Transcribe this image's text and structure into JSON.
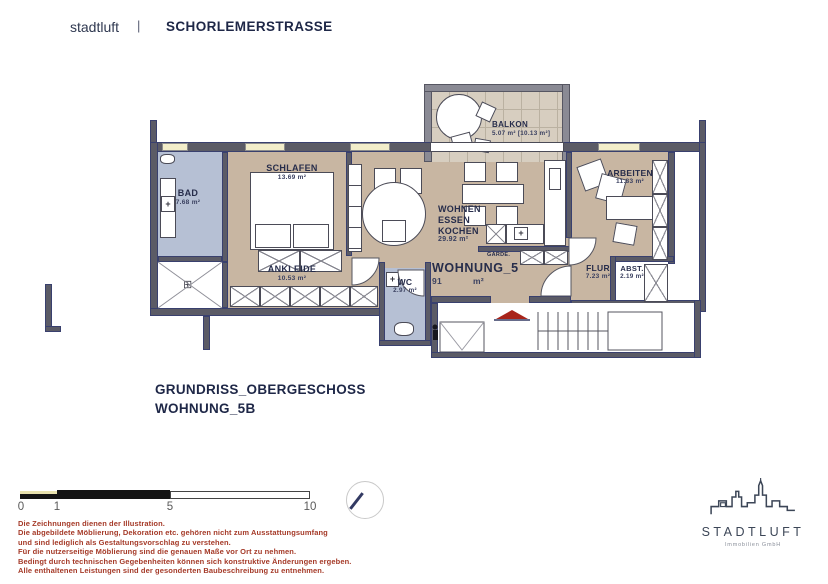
{
  "header": {
    "brand": "stadtluft",
    "separator": "|",
    "project": "SCHORLEMERSTRASSE"
  },
  "floorplan": {
    "rooms": {
      "bad": {
        "name": "BAD",
        "area": "7.68 m²"
      },
      "schlafen": {
        "name": "SCHLAFEN",
        "area": "13.69 m²"
      },
      "ankleide": {
        "name": "ANKLEIDE",
        "area": "10.53 m²"
      },
      "wohnen": {
        "line1": "WOHNEN",
        "line2": "ESSEN",
        "line3": "KOCHEN",
        "area": "29.92 m²"
      },
      "balkon": {
        "name": "BALKON",
        "area": "5.07 m² [10.13 m²]"
      },
      "arbeiten": {
        "name": "ARBEITEN",
        "area": "11.83 m²"
      },
      "flur": {
        "name": "FLUR",
        "area": "7.23 m²"
      },
      "abst": {
        "name": "ABST.",
        "area": "2.19 m²"
      },
      "wc": {
        "name": "WC",
        "area": "2.97 m²"
      },
      "garde": {
        "name": "GARDE."
      }
    },
    "apartment": {
      "name": "WOHNUNG_5",
      "area_value": "91",
      "area_unit": "m²"
    }
  },
  "icons": {
    "plus": "+",
    "drain": "⊞"
  },
  "title_block": {
    "line1": "GRUNDRISS_OBERGESCHOSS",
    "line2": "WOHNUNG_5B"
  },
  "scale_bar": {
    "labels": [
      "0",
      "1",
      "5",
      "10"
    ]
  },
  "disclaimer": {
    "lines": [
      "Die Zeichnungen dienen der Illustration.",
      "Die abgebildete Möblierung, Dekoration etc. gehören nicht zum Ausstattungsumfang",
      "und sind lediglich als Gestaltungsvorschlag zu verstehen.",
      "Für die nutzerseitige Möblierung sind die genauen Maße vor Ort zu nehmen.",
      "Bedingt durch technischen Gegebenheiten können sich konstruktive Änderungen ergeben.",
      "Alle enthaltenen Leistungen sind der gesonderten Baubeschreibung zu entnehmen."
    ]
  },
  "logo": {
    "name": "STADTLUFT",
    "subtitle": "Immobilien GmbH"
  },
  "colors": {
    "floor_tan": "#c8b6a2",
    "floor_blue": "#b6c0d4",
    "wall": "#5b5b66",
    "accent_navy": "#1e2747",
    "disclaimer_red": "#a53a28",
    "arrow_red": "#a8241a"
  }
}
